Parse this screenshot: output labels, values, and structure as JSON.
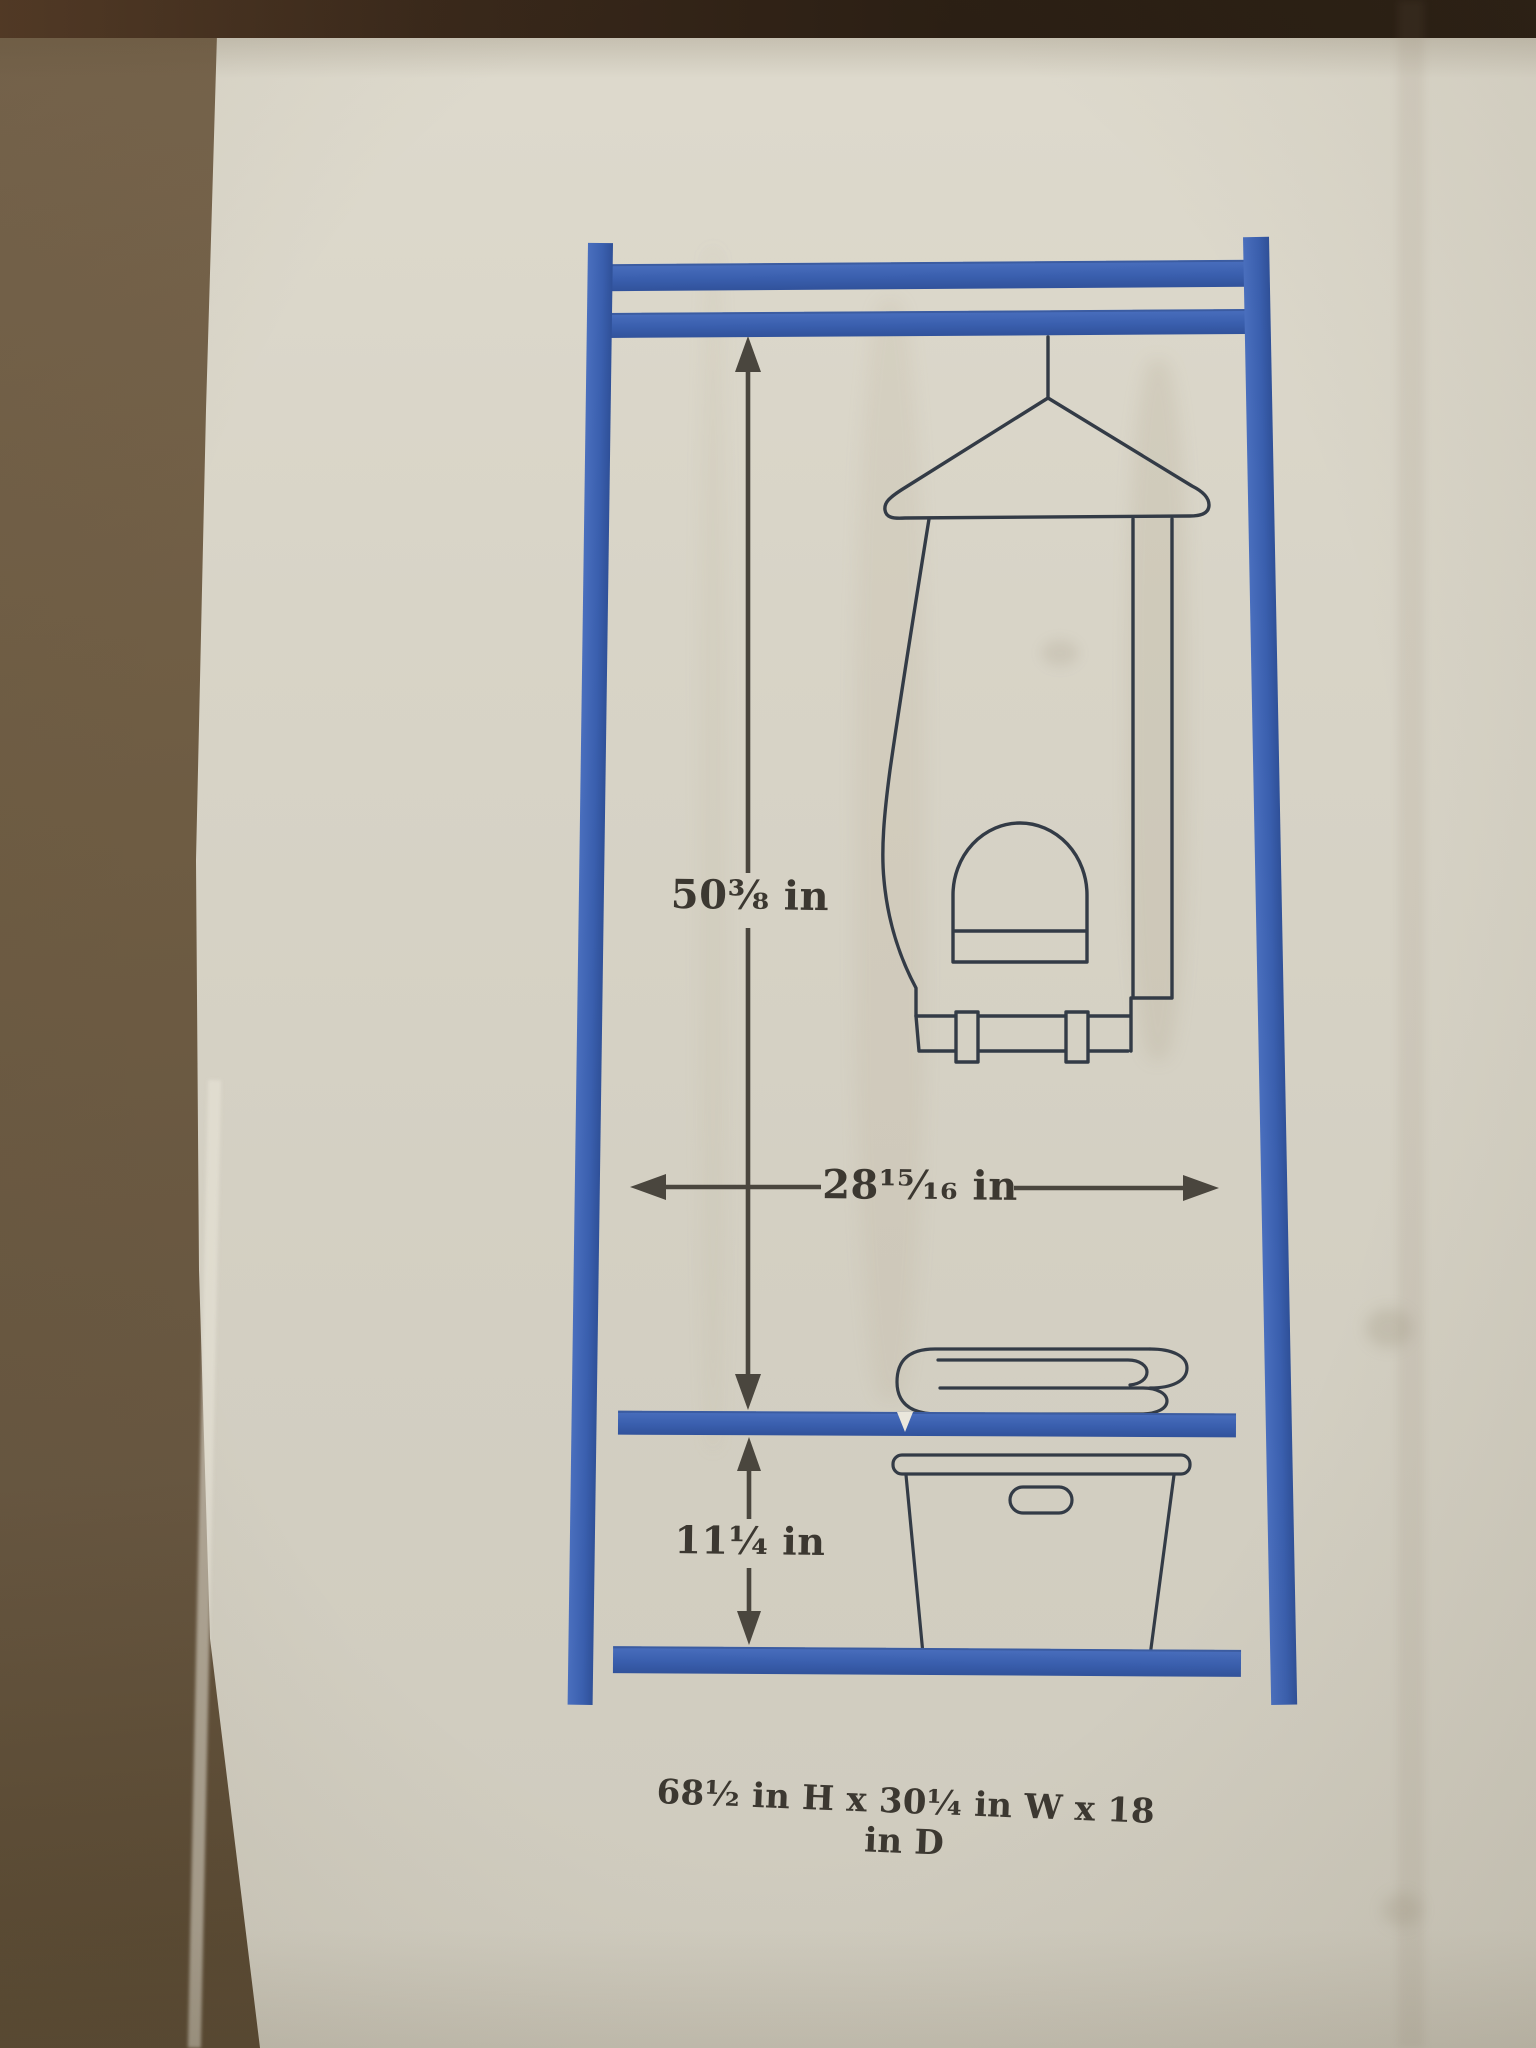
{
  "labels": {
    "upper_height": "50⅜ in",
    "width": "28¹⁵⁄₁₆ in",
    "lower_height": "11¼ in",
    "caption": "68½ in H x 30¼ in W x 18 in D"
  },
  "palette": {
    "frame_blue": "#3e63b2",
    "line_art_ink": "#333b46",
    "dimension_ink": "#45423b",
    "box_face": "#d6d2c5",
    "cardboard_brown": "#6e5c41",
    "top_strip_brown": "#2b1f14"
  },
  "diagram": {
    "elements": [
      "wardrobe-frame",
      "garment-bag-on-hanger",
      "folded-blanket",
      "storage-bin",
      "upper-height-arrow",
      "width-arrow",
      "lower-height-arrow"
    ]
  }
}
